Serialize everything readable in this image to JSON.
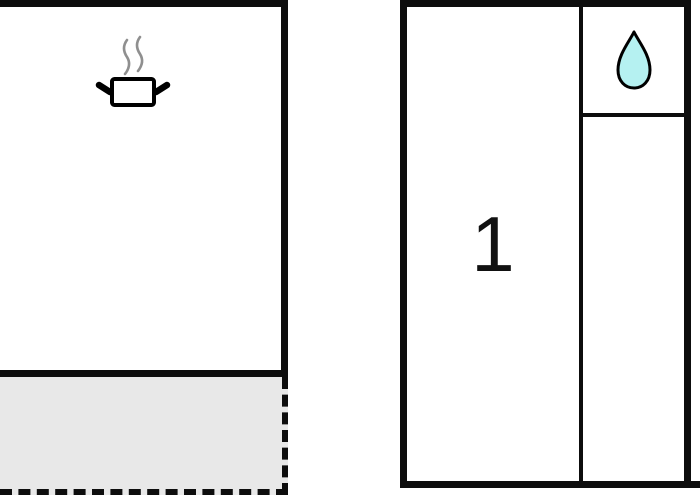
{
  "floorplan": {
    "rooms": {
      "bedroom": {
        "label": "1",
        "icon": null
      },
      "kitchen": {
        "icon": "cooking-pot-icon"
      },
      "bathroom": {
        "icon": "water-drop-icon"
      },
      "terrace": {
        "icon": null
      }
    },
    "colors": {
      "background": "#ffffff",
      "wall": "#0d0d0d",
      "terrace_fill": "#e8e8e8",
      "terrace_border": "#0d0d0d",
      "room_label": "#111111",
      "pot_outline": "#000000",
      "pot_fill": "#ffffff",
      "steam": "#8f8f8f",
      "drop_outline": "#000000",
      "drop_fill": "#b5f1f1"
    }
  }
}
